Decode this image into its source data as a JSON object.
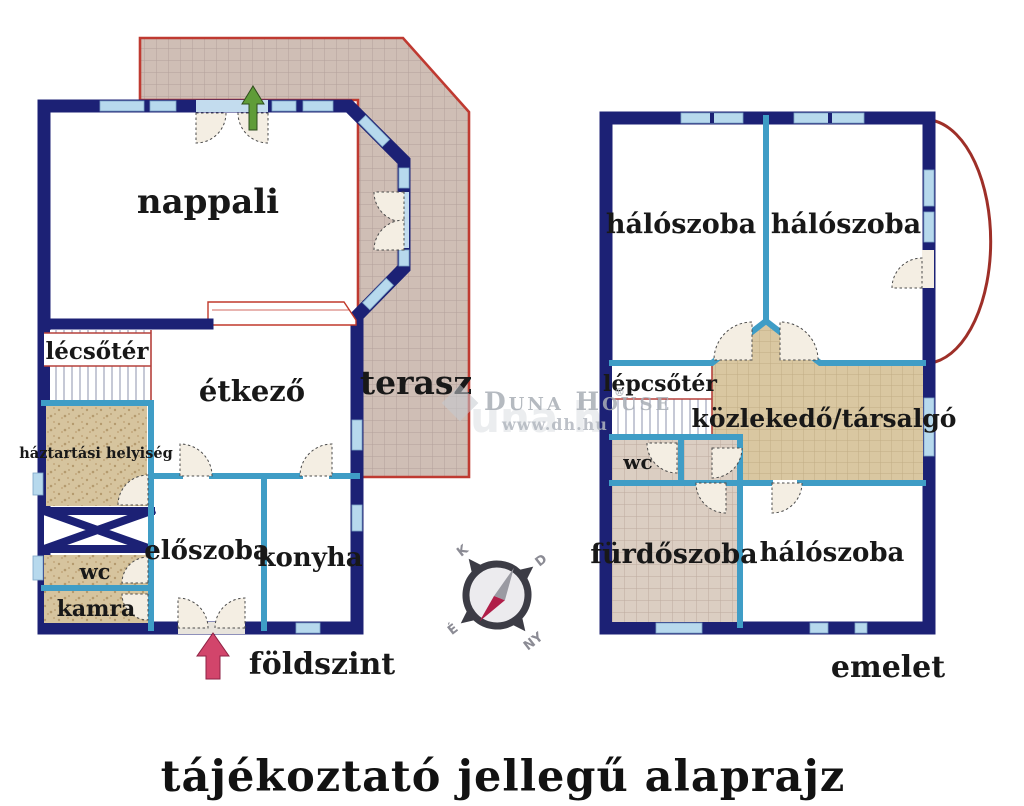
{
  "title": "tájékoztató jellegű alaprajz",
  "watermark": {
    "brand": "Duna House",
    "reg": "®",
    "url": "www.dh.hu",
    "ghost": "duna house"
  },
  "ground_floor": {
    "caption": "földszint",
    "rooms": {
      "nappali": "nappali",
      "lecsoter": "lécsőtér",
      "etkezo": "étkező",
      "terasz": "terasz",
      "haztartasi": "háztartási helyiség",
      "wc": "wc",
      "kamra": "kamra",
      "eloszoba": "előszoba",
      "konyha": "konyha"
    }
  },
  "upper_floor": {
    "caption": "emelet",
    "rooms": {
      "haloszoba_left": "hálószoba",
      "haloszoba_right": "hálószoba",
      "lepcsoter": "lépcsőtér",
      "kozlekedo": "közlekedő/társalgó",
      "wc": "wc",
      "furdoszoba": "fürdőszoba",
      "haloszoba_bottom": "hálószoba"
    }
  },
  "compass": {
    "top": "K",
    "right": "D",
    "bottom": "NY",
    "left": "É"
  },
  "colors": {
    "wall": "#1c2175",
    "partition": "#3f9dc6",
    "window": "#b7d9ed",
    "terrace_border": "#bf3a31",
    "floor_tile": "#d9c7a1",
    "wood": "#e3ba81",
    "entry_arrow": "#d2456b",
    "terrace_arrow": "#5f9c38"
  }
}
